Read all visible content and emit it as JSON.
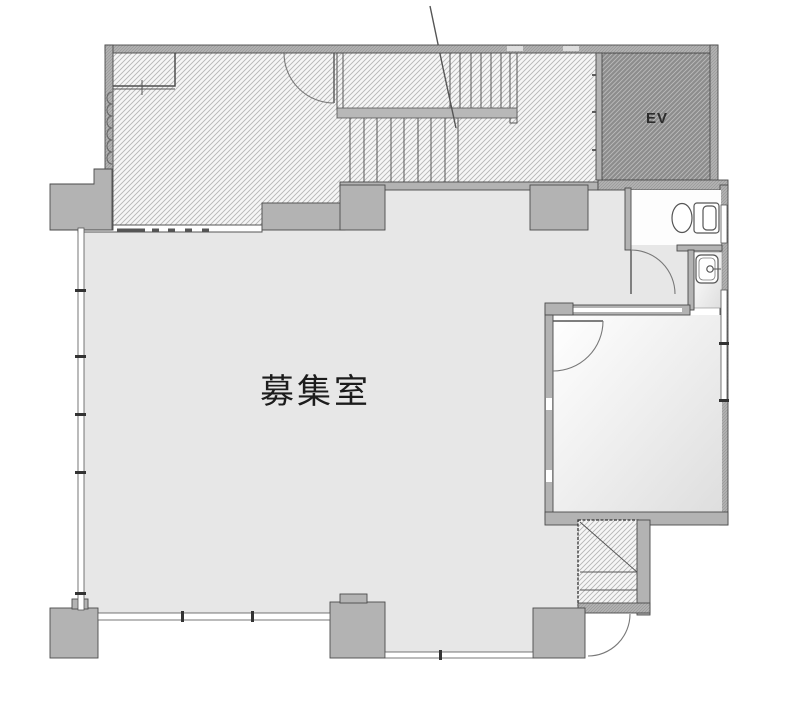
{
  "plan": {
    "labels": {
      "main_room": "募集室",
      "elevator": "EV"
    },
    "colors": {
      "floor": "#e7e7e7",
      "wall": "#b3b3b3",
      "wall_edge": "#4a4a4a",
      "hatch_bg": "#f6f6f6",
      "hatch_line": "#b5b5b5",
      "ev_bg": "#8d8d8d",
      "ev_line": "#bdbdbd",
      "line": "#555555",
      "text": "#1c1c1c",
      "room_grad_start": "#ffffff",
      "room_grad_end": "#dedede"
    }
  }
}
